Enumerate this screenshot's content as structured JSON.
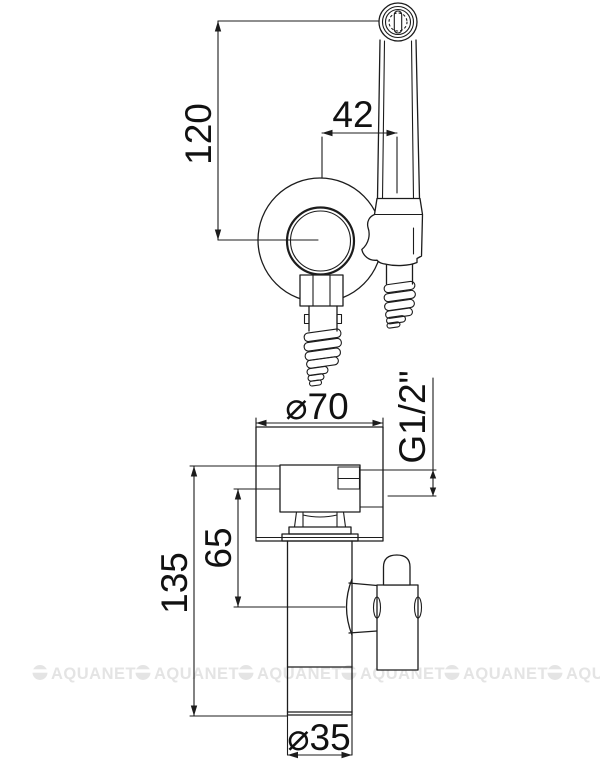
{
  "watermark": {
    "label": "AQUANET",
    "count": 6,
    "color": "#e4e4e4"
  },
  "colors": {
    "line": "#1c1c1c",
    "text": "#111111",
    "background": "#ffffff"
  },
  "dimensions": {
    "upper_view": {
      "holder_height": "120",
      "head_offset": "42"
    },
    "lower_view": {
      "flange_width": "⌀70",
      "thread": "G1/2\"",
      "upper_section_height": "65",
      "total_height": "135",
      "body_diameter": "⌀35"
    }
  }
}
